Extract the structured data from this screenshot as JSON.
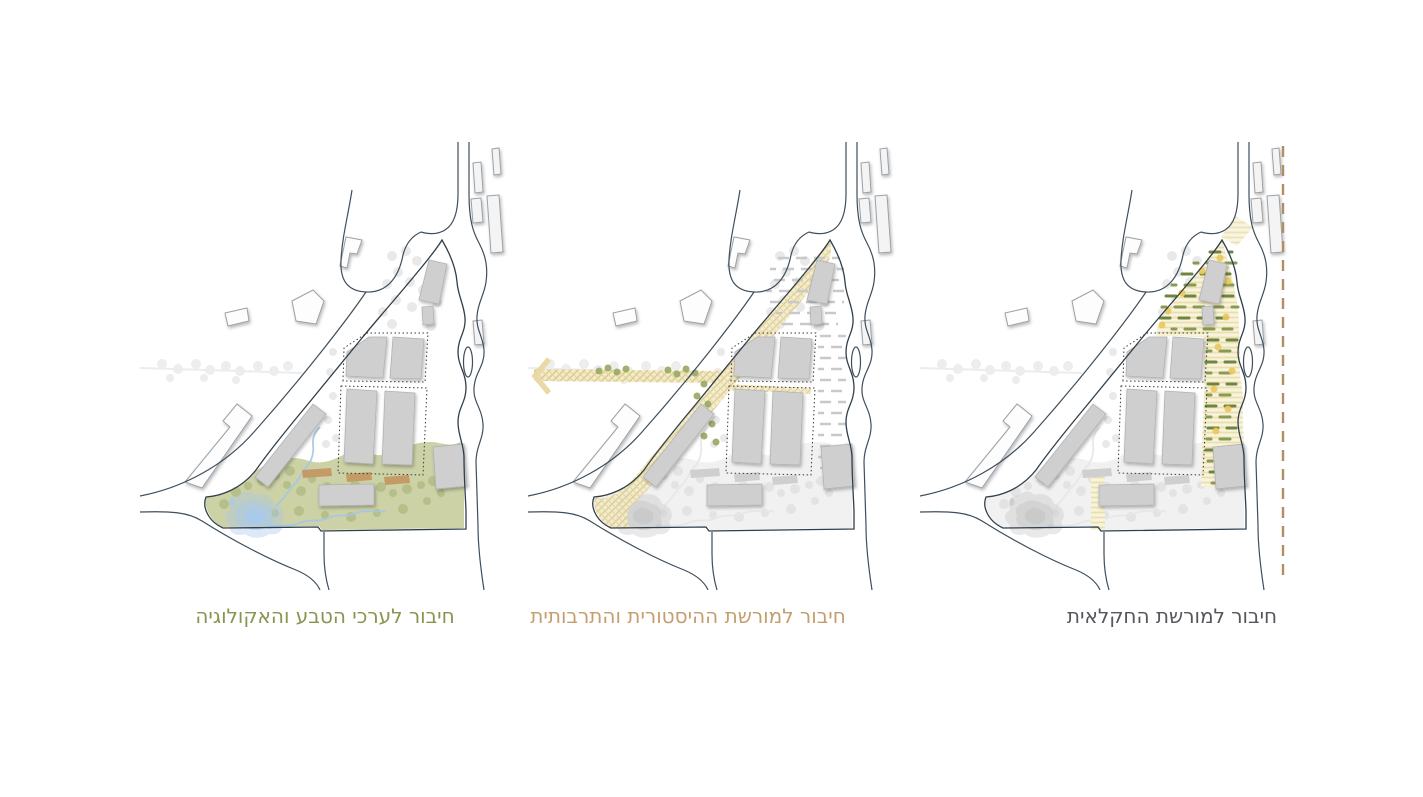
{
  "page": {
    "background": "#ffffff",
    "description_names": [
      "site-plan-diagram-ecology",
      "site-plan-diagram-heritage",
      "site-plan-diagram-agriculture"
    ]
  },
  "map_base_colors": {
    "roads": "#3e4e5c",
    "site_outline": "#2f3e4a",
    "site_buildings_gray": "#cfcfcf",
    "context_buildings_white": "#fdfdfd",
    "dotted_block_outline": "#3a3a3a"
  },
  "panels": [
    {
      "id": "nature-ecology",
      "caption": "חיבור לערכי הטבע והאקולוגיה",
      "caption_color": "#87964f",
      "legend": {
        "ground_green": "#ccd1a6",
        "vegetation_green": "#b5bf8a",
        "water_blue": "#a9c9e9",
        "highlight_buildings_brown": "#c49b67"
      }
    },
    {
      "id": "historic-cultural-heritage",
      "caption": "חיבור למורשת ההיסטורית והתרבותית",
      "caption_color": "#c59e6f",
      "legend": {
        "heritage_path_tan": "#e6d49a",
        "path_trees_green": "#9dab68",
        "field_rows_gray": "#c9c9c9",
        "arrow_icon": "west-chevron-arrow"
      }
    },
    {
      "id": "agricultural-heritage",
      "caption": "חיבור למורשת החקלאית",
      "caption_color": "#55575c",
      "legend": {
        "field_strip_cream": "#f6f1d8",
        "crop_rows_green": "#6f8440",
        "crop_dots_yellow": "#ebc85c",
        "boundary_dashed_brown": "#b18e63"
      }
    }
  ]
}
